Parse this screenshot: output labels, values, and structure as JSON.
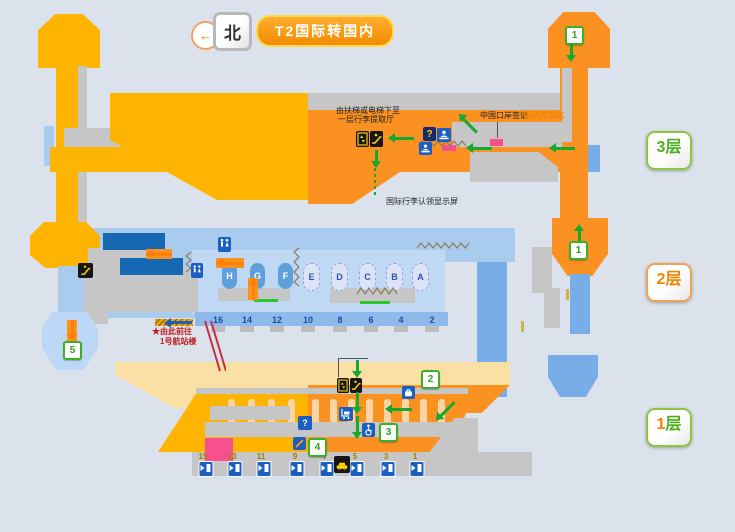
{
  "header": {
    "north_label": "北",
    "title": "T2国际转国内"
  },
  "icons": {
    "back_arrow": "←",
    "question_mark": "?"
  },
  "floor_buttons": [
    {
      "label": "3层"
    },
    {
      "label": "2层"
    },
    {
      "label": "1层"
    }
  ],
  "floor3": {
    "escalator_note_line1": "由扶梯或电梯下至",
    "escalator_note_line2": "一层行李提取厅",
    "china_visa_label": "中国口岸签证",
    "remote_stand_arrival_label": "远机位到达",
    "baggage_screen_label": "国际行李认领显示屏",
    "route_marker": "1"
  },
  "floor2": {
    "gate_letters": [
      "H",
      "G",
      "F",
      "E",
      "D",
      "C",
      "B",
      "A"
    ],
    "gate_numbers": [
      "16",
      "14",
      "12",
      "10",
      "8",
      "6",
      "4",
      "2"
    ],
    "route_marker": "1",
    "shuttle_marker": "5",
    "to_t1_line1": "★由此前往",
    "to_t1_line2": "1号航站楼"
  },
  "floor1": {
    "exit_numbers": [
      "15",
      "13",
      "11",
      "9",
      "7",
      "5",
      "3",
      "1"
    ],
    "route_markers": {
      "m2": "2",
      "m3": "3",
      "m4": "4"
    }
  },
  "colors": {
    "gold": "#FFB401",
    "orange": "#FB9120",
    "cream": "#FBE0A6",
    "light_blue": "#A9CBEE",
    "dark_blue": "#1668B3",
    "route_green": "#17A82F",
    "accent_orange": "#F08300",
    "pink": "#F6508D",
    "title_bg": "#F7941D",
    "background": "#DBE2EC"
  }
}
